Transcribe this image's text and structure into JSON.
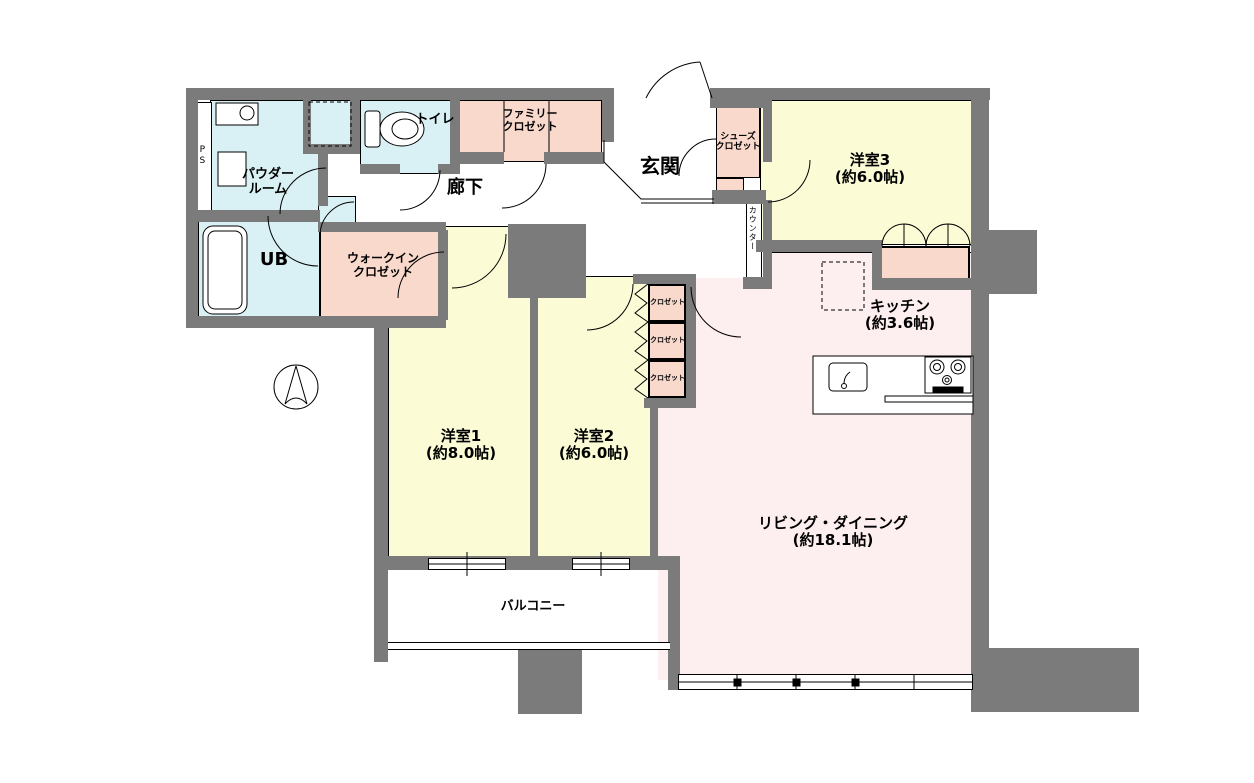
{
  "colors": {
    "wall": "#7b7b7b",
    "wet": "#d9f1f4",
    "closet": "#f9d9cc",
    "room": "#fbfbd6",
    "ldk": "#fdeef0",
    "line": "#000000"
  },
  "rooms": {
    "living": {
      "name": "リビング・ダイニング",
      "size": "(約18.1帖)"
    },
    "kitchen": {
      "name": "キッチン",
      "size": "(約3.6帖)"
    },
    "yoshitsu1": {
      "name": "洋室1",
      "size": "(約8.0帖)"
    },
    "yoshitsu2": {
      "name": "洋室2",
      "size": "(約6.0帖)"
    },
    "yoshitsu3": {
      "name": "洋室3",
      "size": "(約6.0帖)"
    },
    "powder_room": {
      "line1": "パウダー",
      "line2": "ルーム"
    },
    "unit_bath": {
      "name": "UB"
    },
    "toilet": {
      "name": "トイレ"
    },
    "genkan": {
      "name": "玄関"
    },
    "hallway": {
      "name": "廊下"
    },
    "balcony": {
      "name": "バルコニー"
    },
    "family_closet": {
      "line1": "ファミリー",
      "line2": "クロゼット"
    },
    "walk_in_closet": {
      "line1": "ウォークイン",
      "line2": "クロゼット"
    },
    "shoes_closet": {
      "line1": "シューズ",
      "line2": "クロゼット"
    },
    "closet": {
      "name": "クロゼット"
    },
    "counter": {
      "name": "カウンター"
    },
    "pipe_space": {
      "name": "PS"
    }
  }
}
